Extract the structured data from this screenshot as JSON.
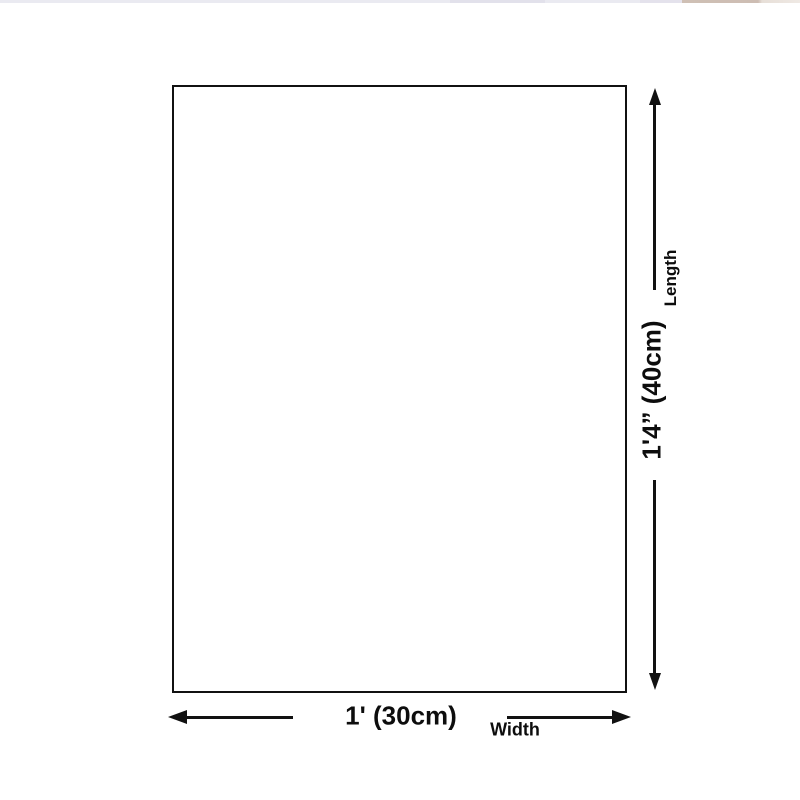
{
  "page": {
    "background_color": "#ffffff",
    "line_color": "#111111"
  },
  "top_strip": {
    "colors": [
      "#eaeaf1",
      "#e2e1eb",
      "#cdbdb3",
      "#e7dfd8"
    ]
  },
  "diagram": {
    "type": "product-dimension-diagram",
    "length": {
      "value": "1'4” (40cm)",
      "label": "Length"
    },
    "width": {
      "value": "1' (30cm)",
      "label": "Width"
    }
  }
}
